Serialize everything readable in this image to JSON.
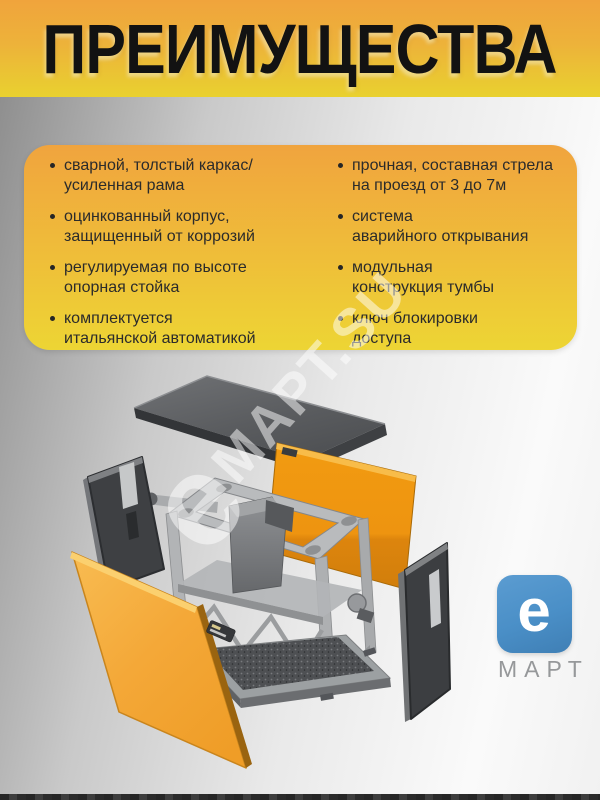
{
  "header": {
    "title": "ПРЕИМУЩЕСТВА"
  },
  "advantages": {
    "left": [
      "сварной, толстый каркас/\nусиленная рама",
      "оцинкованный корпус,\nзащищенный от коррозий",
      "регулируемая по высоте\nопорная стойка",
      "комплектуется\nитальянской автоматикой"
    ],
    "right": [
      "прочная, составная стрела\nна проезд от 3 до 7м",
      "система\nаварийного открывания",
      "модульная\nконструкция тумбы",
      "ключ блокировки\nдоступа"
    ]
  },
  "watermark": {
    "e": "e",
    "text": "МАРТ.SU"
  },
  "logo": {
    "letter": "e",
    "brand": "МАРТ"
  },
  "colors": {
    "header_orange": "#F0A43C",
    "header_yellow": "#E9D12F",
    "card_orange": "#F0A43E",
    "card_yellow": "#EDD534",
    "panel_orange": "#F2A838",
    "panel_dark": "#3E4043",
    "frame_grey": "#B6B8BA",
    "logo_blue": "#4A8FC7",
    "text_dark": "#2B2B2B"
  },
  "diagram": {
    "parts": [
      "top-lid",
      "left-side-panel",
      "front-panel",
      "rear-panel",
      "right-side-panel",
      "frame-with-drive",
      "base-plate"
    ]
  }
}
